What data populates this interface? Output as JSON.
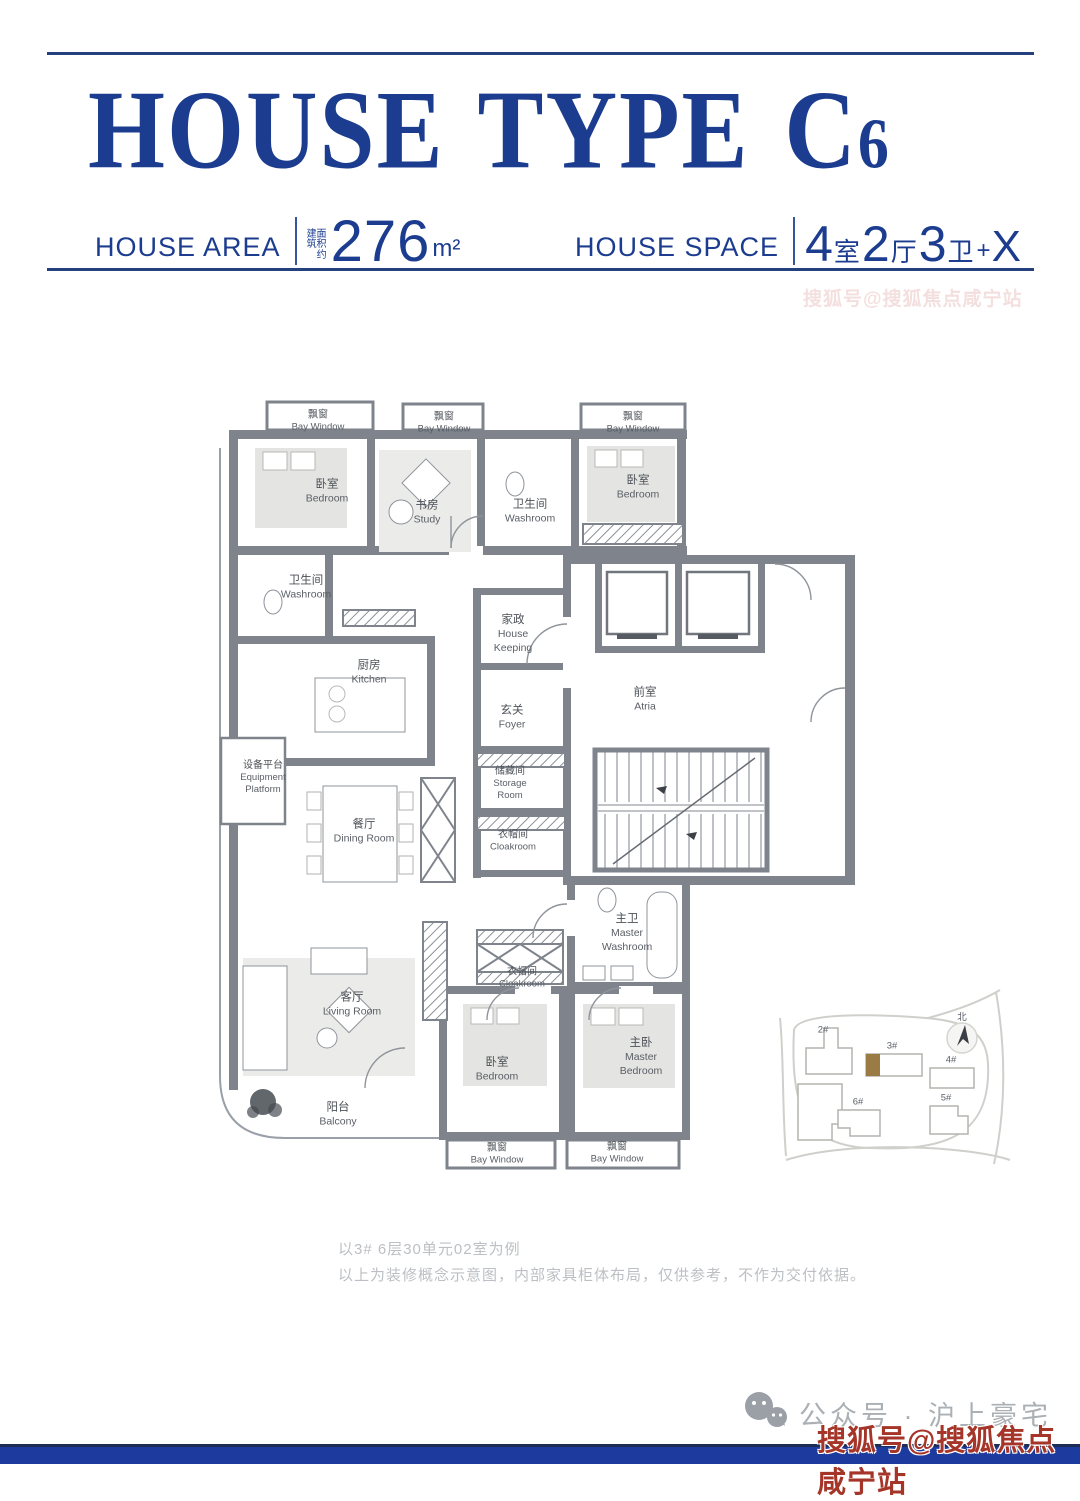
{
  "header": {
    "title_main": "HOUSE TYPE C",
    "title_num": "6",
    "area": {
      "label": "HOUSE AREA",
      "note_l1": "建面",
      "note_l2": "筑积",
      "note_l3": "约",
      "value": "276",
      "unit": "m²"
    },
    "space": {
      "label": "HOUSE SPACE",
      "n1": "4",
      "u1": "室",
      "n2": "2",
      "u2": "厅",
      "n3": "3",
      "u3": "卫",
      "plus": "+",
      "x": "X"
    }
  },
  "watermark": {
    "text": "搜狐号@搜狐焦点咸宁站"
  },
  "footer": {
    "account": "公众号 · 沪上豪宅"
  },
  "rooms": {
    "bay_tl": {
      "zh": "飘窗",
      "en": "Bay Window"
    },
    "bay_tm": {
      "zh": "飘窗",
      "en": "Bay Window"
    },
    "bay_tr": {
      "zh": "飘窗",
      "en": "Bay Window"
    },
    "bay_bl": {
      "zh": "飘窗",
      "en": "Bay Window"
    },
    "bay_br": {
      "zh": "飘窗",
      "en": "Bay Window"
    },
    "bedroom_tl": {
      "zh": "卧室",
      "en": "Bedroom"
    },
    "bedroom_tr": {
      "zh": "卧室",
      "en": "Bedroom"
    },
    "bedroom_b": {
      "zh": "卧室",
      "en": "Bedroom"
    },
    "study": {
      "zh": "书房",
      "en": "Study"
    },
    "washroom_top": {
      "zh": "卫生间",
      "en": "Washroom"
    },
    "washroom_left": {
      "zh": "卫生间",
      "en": "Washroom"
    },
    "housekeeping": {
      "zh": "家政",
      "en1": "House",
      "en2": "Keeping"
    },
    "kitchen": {
      "zh": "厨房",
      "en": "Kitchen"
    },
    "foyer": {
      "zh": "玄关",
      "en": "Foyer"
    },
    "atria": {
      "zh": "前室",
      "en": "Atria"
    },
    "equipment": {
      "zh": "设备平台",
      "en1": "Equipment",
      "en2": "Platform"
    },
    "dining": {
      "zh": "餐厅",
      "en": "Dining Room"
    },
    "storage": {
      "zh": "储藏间",
      "en1": "Storage",
      "en2": "Room"
    },
    "cloakroom_u": {
      "zh": "衣帽间",
      "en": "Cloakroom"
    },
    "cloakroom_l": {
      "zh": "衣帽间",
      "en": "Cloakroom"
    },
    "master_wash": {
      "zh": "主卫",
      "en1": "Master",
      "en2": "Washroom"
    },
    "living": {
      "zh": "客厅",
      "en": "Living Room"
    },
    "master_bed": {
      "zh": "主卧",
      "en1": "Master",
      "en2": "Bedroom"
    },
    "balcony": {
      "zh": "阳台",
      "en": "Balcony"
    }
  },
  "site_plan": {
    "buildings": {
      "b2": "2#",
      "b3": "3#",
      "b4": "4#",
      "b5": "5#",
      "b6": "6#"
    },
    "north": "北"
  },
  "notes": {
    "line1": "以3# 6层30单元02室为例",
    "line2": "以上为装修概念示意图，内部家具柜体布局，仅供参考，不作为交付依据。"
  },
  "colors": {
    "brand_blue": "#1c3d8f",
    "wall_gray": "#7e838c",
    "watermark_red": "#a63529",
    "footer_bar_blue": "#1d3a9e",
    "note_gray": "#bcbfc3",
    "account_gray": "#abb0b5",
    "site_highlight_gold": "#9a7b43"
  }
}
